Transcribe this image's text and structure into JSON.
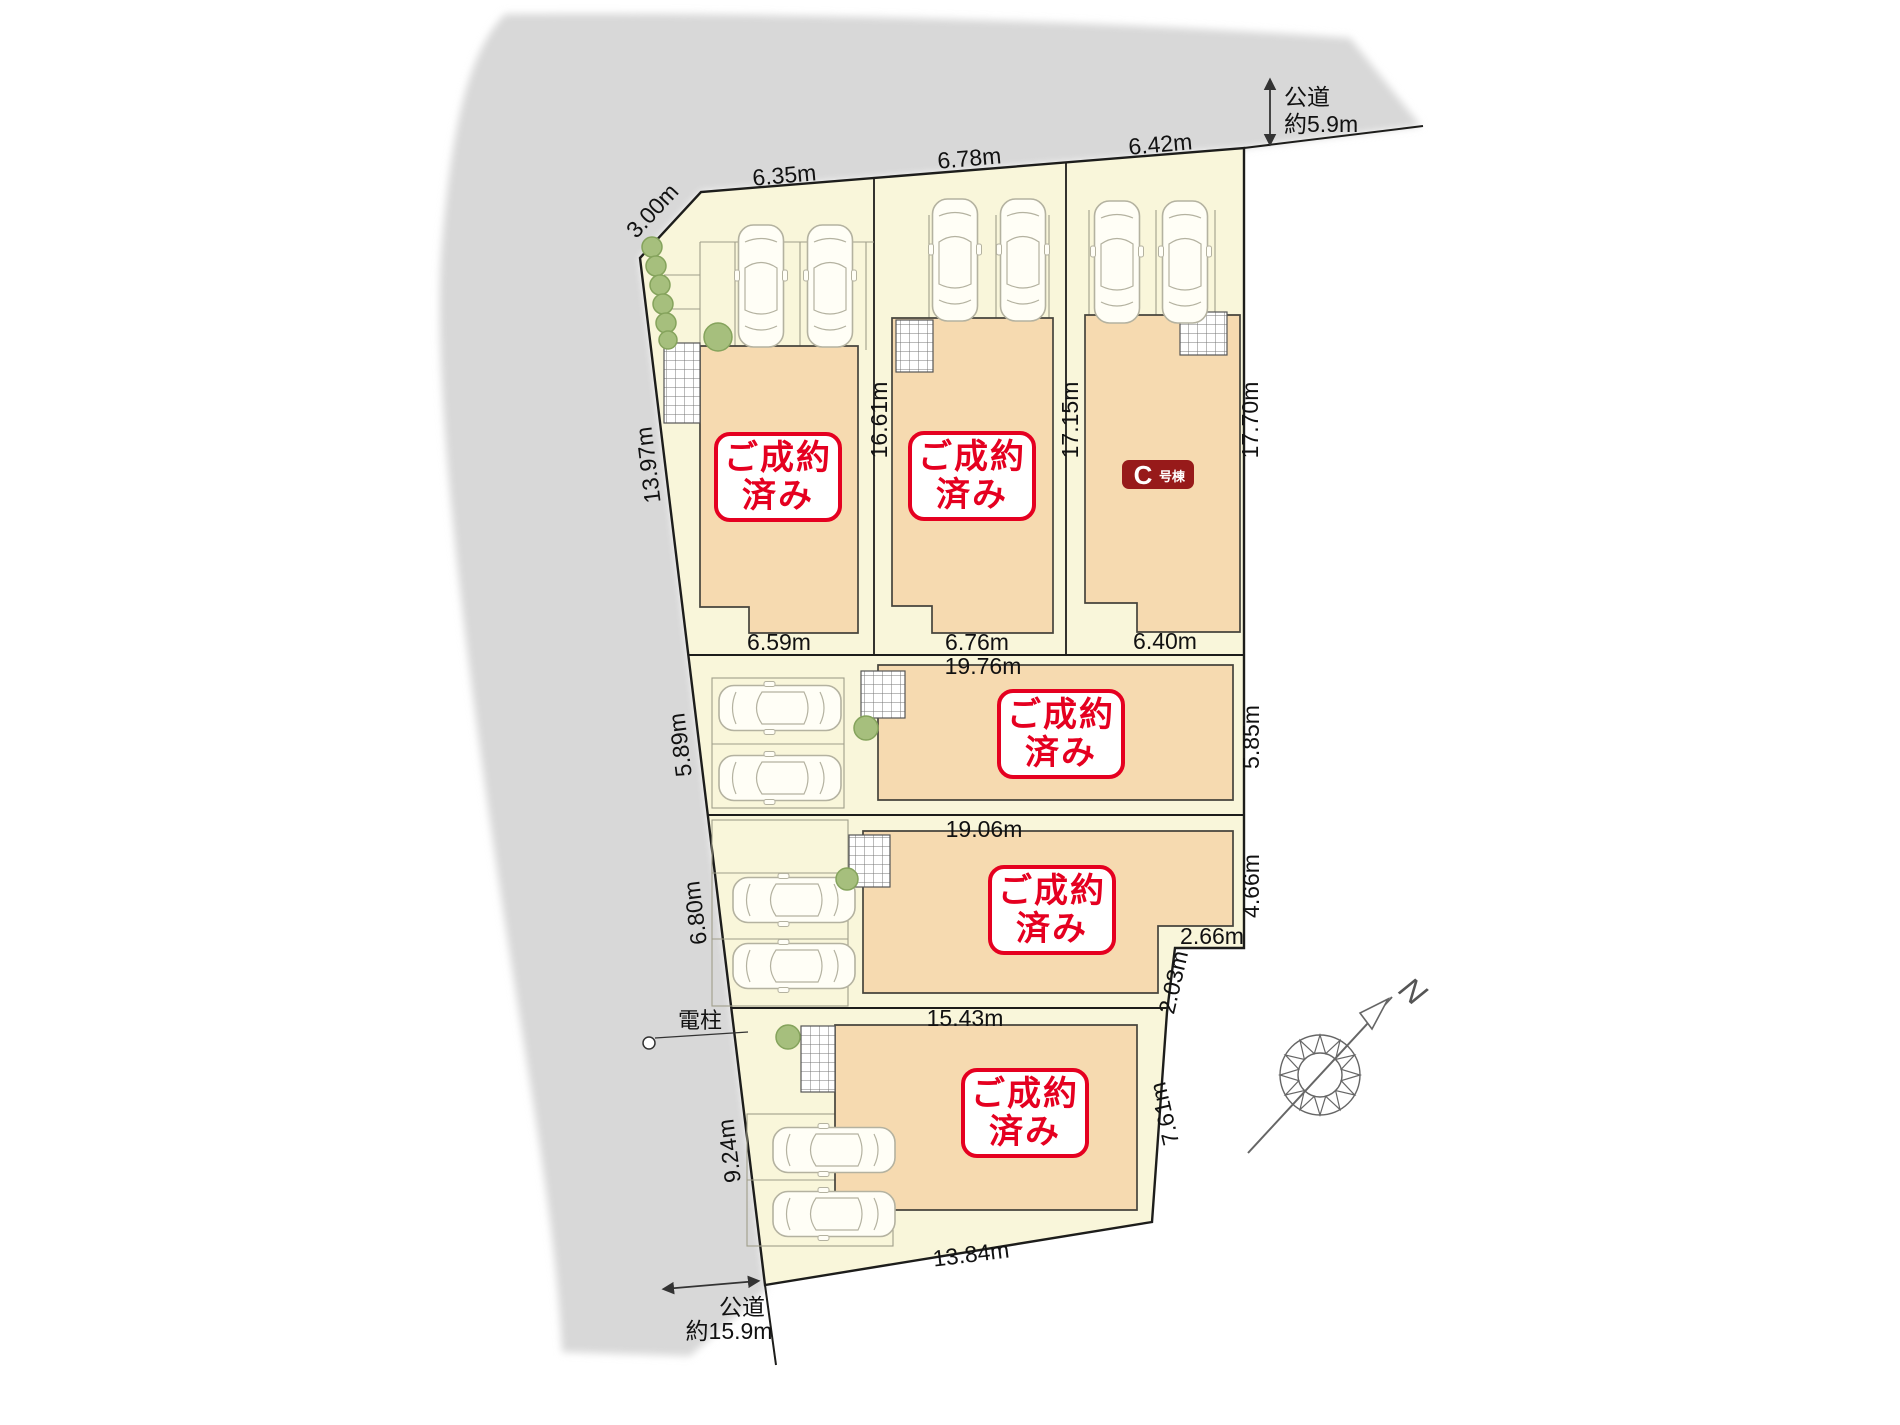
{
  "colors": {
    "road": "#d8d8d8",
    "lot_ground": "#f9f6da",
    "building": "#f6dab0",
    "stamp_red": "#e50020",
    "badge_red": "#971a1a",
    "tree_green": "#a6bf7d"
  },
  "road_top": {
    "name": "公道",
    "width": "約5.9m"
  },
  "road_bottom": {
    "name": "公道",
    "width": "約15.9m"
  },
  "utility_pole": {
    "label": "電柱"
  },
  "compass": {
    "label": "N"
  },
  "sold_stamp": {
    "line1": "ご成約",
    "line2": "済み"
  },
  "building_c": {
    "letter": "C",
    "suffix": "号棟"
  },
  "dims": {
    "corner_cut": "3.00m",
    "row1_top": [
      "6.35m",
      "6.78m",
      "6.42m"
    ],
    "row1_bottom": [
      "6.59m",
      "6.76m",
      "6.40m"
    ],
    "row1_left": "13.97m",
    "divider_left": "16.61m",
    "divider_right": "17.15m",
    "row1_right": "17.70m",
    "lot4_top": "19.76m",
    "lot4_left": "5.89m",
    "lot4_right": "5.85m",
    "lot5_top": "19.06m",
    "lot5_left": "6.80m",
    "lot5_right": "4.66m",
    "lot5_step": "2.66m",
    "lot5_diag": "2.03m",
    "lot6_top": "15.43m",
    "lot6_left": "9.24m",
    "lot6_right": "7.61m",
    "lot6_bottom": "13.84m"
  }
}
